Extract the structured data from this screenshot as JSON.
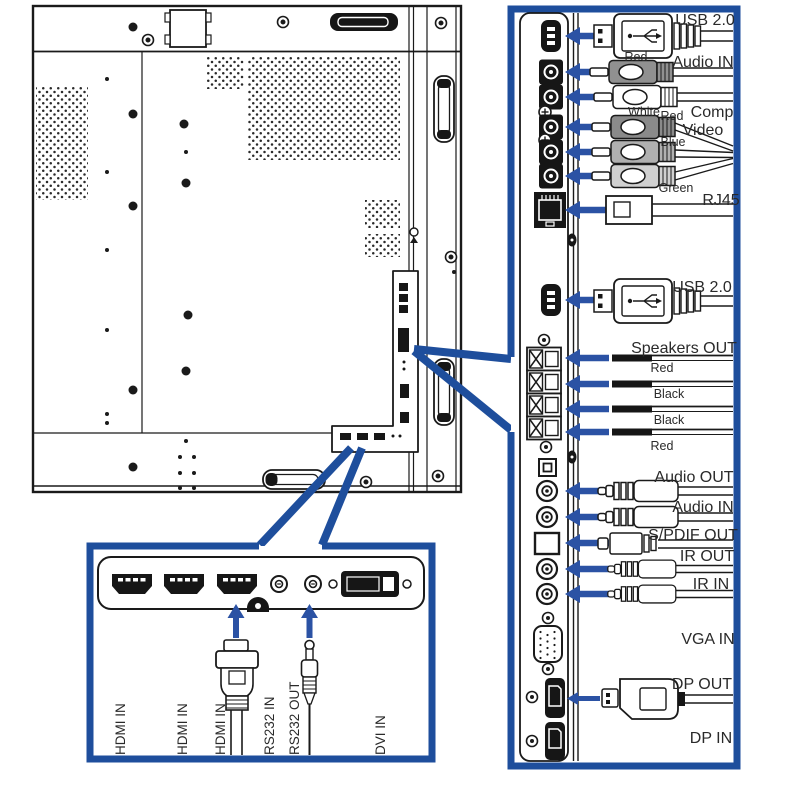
{
  "colors": {
    "panel_border": "#1e4e9c",
    "arrow_blue": "#2b52a4",
    "line": "#1a1a1a"
  },
  "right_panel": {
    "usb_top": {
      "label": "USB 2.0"
    },
    "audio_in_rca": {
      "label": "Audio IN",
      "plug1": "Red",
      "plug2": "White"
    },
    "component_video": {
      "label_line1": "Comp",
      "label_line2": "Video",
      "plug1": "Red",
      "plug2": "Blue",
      "plug3": "Green"
    },
    "rj45": {
      "label": "RJ45"
    },
    "usb_bottom": {
      "label": "USB 2.0"
    },
    "speakers": {
      "label": "Speakers OUT",
      "wires": [
        "Red",
        "Black",
        "Black",
        "Red"
      ]
    },
    "audio_out": {
      "label": "Audio OUT"
    },
    "audio_in_jack": {
      "label": "Audio IN"
    },
    "spdif_out": {
      "label": "S/PDIF OUT"
    },
    "ir_out": {
      "label": "IR OUT"
    },
    "ir_in": {
      "label": "IR IN"
    },
    "vga_in": {
      "label": "VGA IN"
    },
    "dp_out": {
      "label": "DP OUT"
    },
    "dp_in": {
      "label": "DP IN"
    }
  },
  "bottom_panel": {
    "ports": [
      "HDMI IN",
      "HDMI IN",
      "HDMI IN",
      "RS232 IN",
      "RS232 OUT",
      "DVI IN"
    ]
  }
}
